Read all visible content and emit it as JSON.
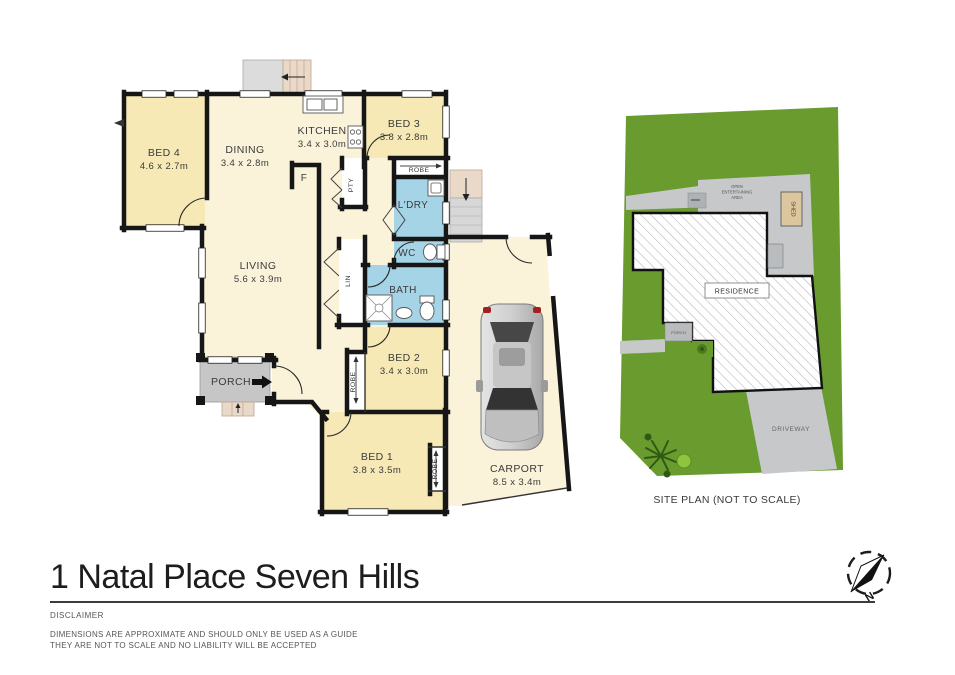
{
  "title": "1 Natal Place Seven Hills",
  "disclaimer": {
    "heading": "DISCLAIMER",
    "line1": "DIMENSIONS ARE APPROXIMATE AND SHOULD ONLY BE USED AS A GUIDE",
    "line2": "THEY ARE NOT TO SCALE AND NO LIABILITY WILL BE ACCEPTED"
  },
  "floorplan": {
    "rooms": {
      "bed4": {
        "name": "BED 4",
        "dims": "4.6 x 2.7m"
      },
      "dining": {
        "name": "DINING",
        "dims": "3.4 x 2.8m"
      },
      "kitchen": {
        "name": "KITCHEN",
        "dims": "3.4 x 3.0m"
      },
      "bed3": {
        "name": "BED 3",
        "dims": "3.8 x 2.8m"
      },
      "living": {
        "name": "LIVING",
        "dims": "5.6 x 3.9m"
      },
      "laundry": {
        "name": "L'DRY"
      },
      "wc": {
        "name": "WC"
      },
      "bath": {
        "name": "BATH"
      },
      "bed2": {
        "name": "BED 2",
        "dims": "3.4 x 3.0m"
      },
      "bed1": {
        "name": "BED 1",
        "dims": "3.8 x 3.5m"
      },
      "porch": {
        "name": "PORCH"
      },
      "carport": {
        "name": "CARPORT",
        "dims": "8.5 x 3.4m"
      }
    },
    "closets": {
      "robe_bed3": "ROBE",
      "robe_bed2": "ROBE",
      "robe_bed1": "ROBE",
      "pantry": "PTY",
      "linen": "LIN",
      "fridge": "F"
    }
  },
  "siteplan": {
    "residence_label": "RESIDENCE",
    "shed_label": "SHED",
    "driveway_label": "DRIVEWAY",
    "porch_label": "PORCH",
    "open_area_line1": "OPEN",
    "open_area_line2": "ENTERTAINING",
    "open_area_line3": "AREA",
    "caption": "SITE PLAN (NOT TO SCALE)"
  },
  "compass": {
    "north_label": "N"
  },
  "colors": {
    "wall": "#161616",
    "room_yellow": "#f6e9b5",
    "room_cream": "#faf3da",
    "room_wet_blue": "#a5d4e6",
    "porch_gray": "#c6c6c6",
    "steps_gray": "#d9d9d9",
    "steps_tan": "#ead8c8",
    "lawn_green": "#699b2e",
    "paving_gray": "#c6c8ca",
    "shed_tan": "#dbc69e"
  }
}
